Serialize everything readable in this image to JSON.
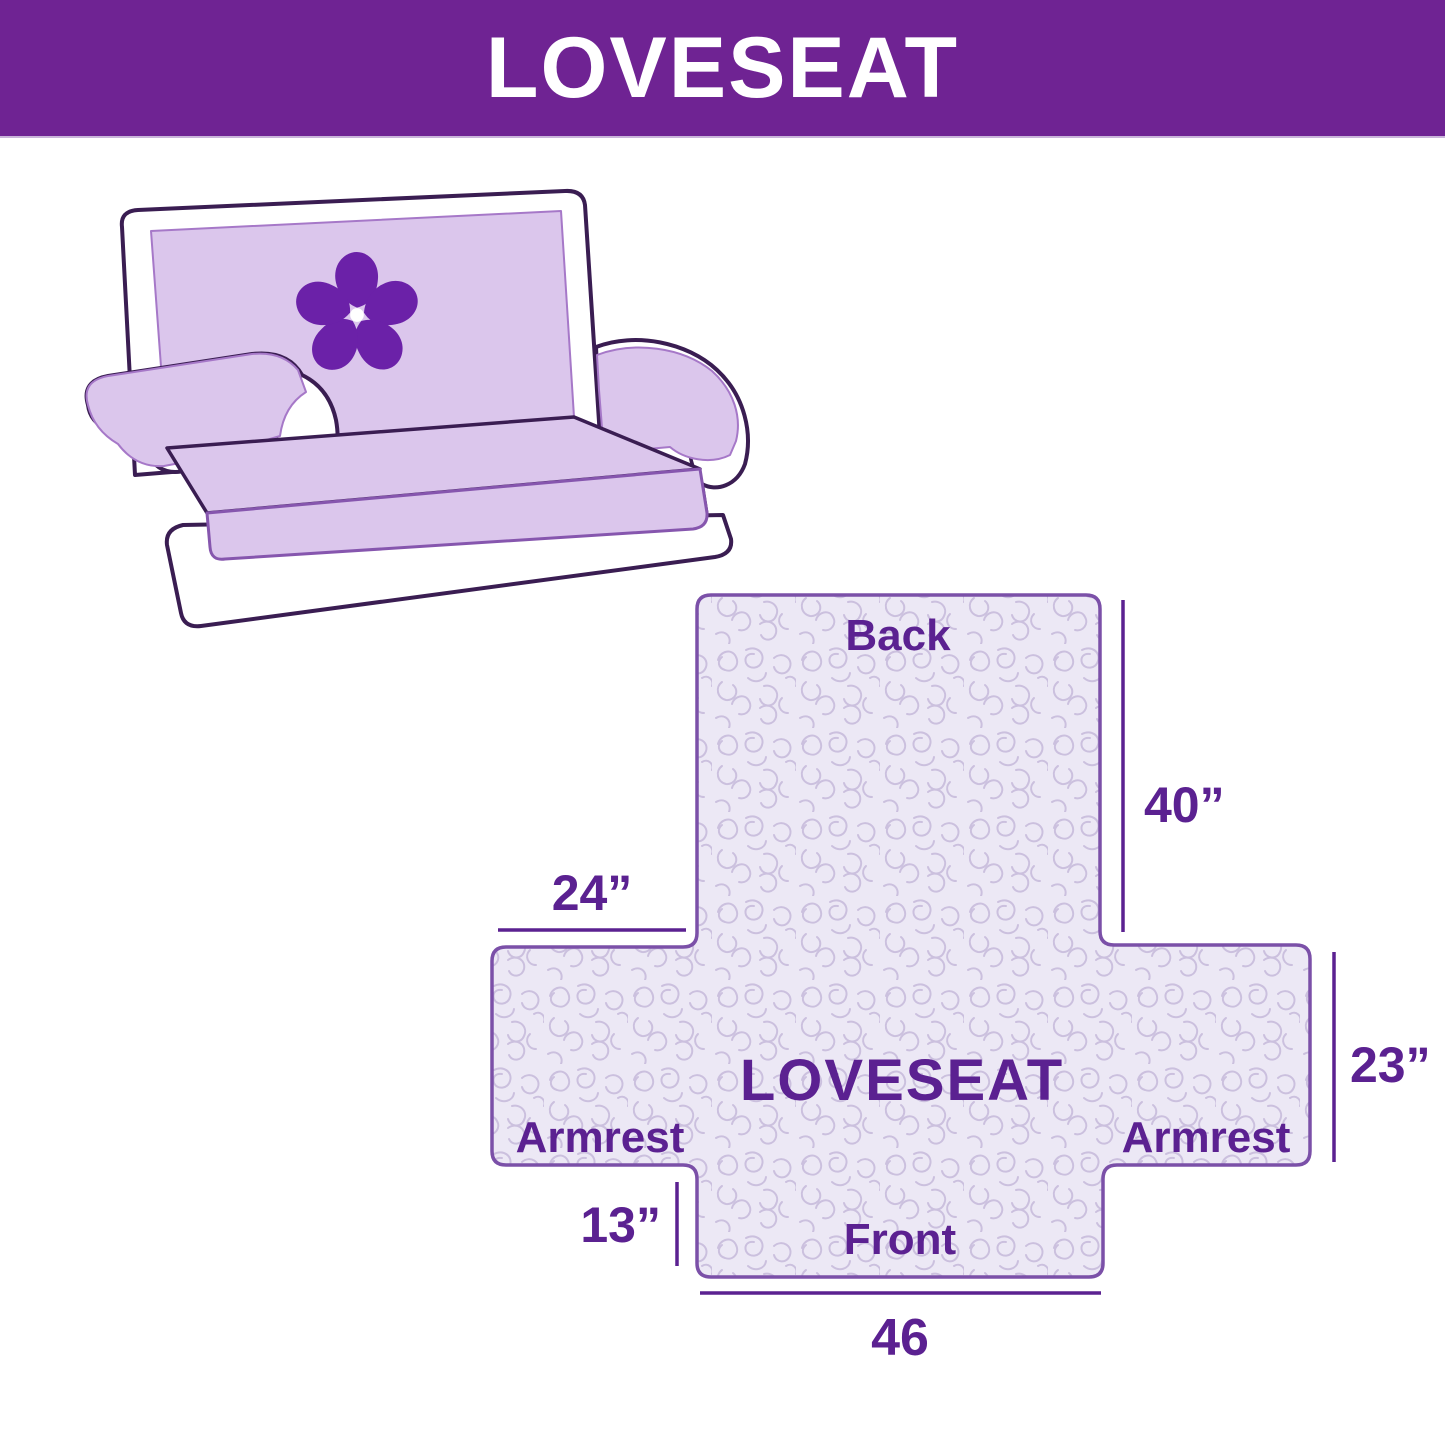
{
  "header": {
    "title": "LOVESEAT"
  },
  "illustration": {
    "alt": "loveseat sofa draped with quilted furniture cover",
    "logo_icon": "pinwheel-flower-icon"
  },
  "diagram": {
    "labels": {
      "back": "Back",
      "center": "LOVESEAT",
      "armrest_left": "Armrest",
      "armrest_right": "Armrest",
      "front": "Front"
    },
    "dimensions": {
      "back_height": "40”",
      "armrest_top_width": "24”",
      "armrest_side_height": "23”",
      "front_drop_height": "13”",
      "front_width": "46"
    }
  },
  "colors": {
    "banner_bg": "#6F2393",
    "banner_text": "#FFFFFF",
    "sofa_outline": "#3A1D52",
    "cover_fill": "#DBC6EC",
    "logo_purple": "#6B21A8",
    "diagram_fill": "#ECE8F5",
    "diagram_pattern": "#CBC0DE",
    "diagram_outline": "#7B50A8",
    "diagram_text": "#5B2191"
  }
}
